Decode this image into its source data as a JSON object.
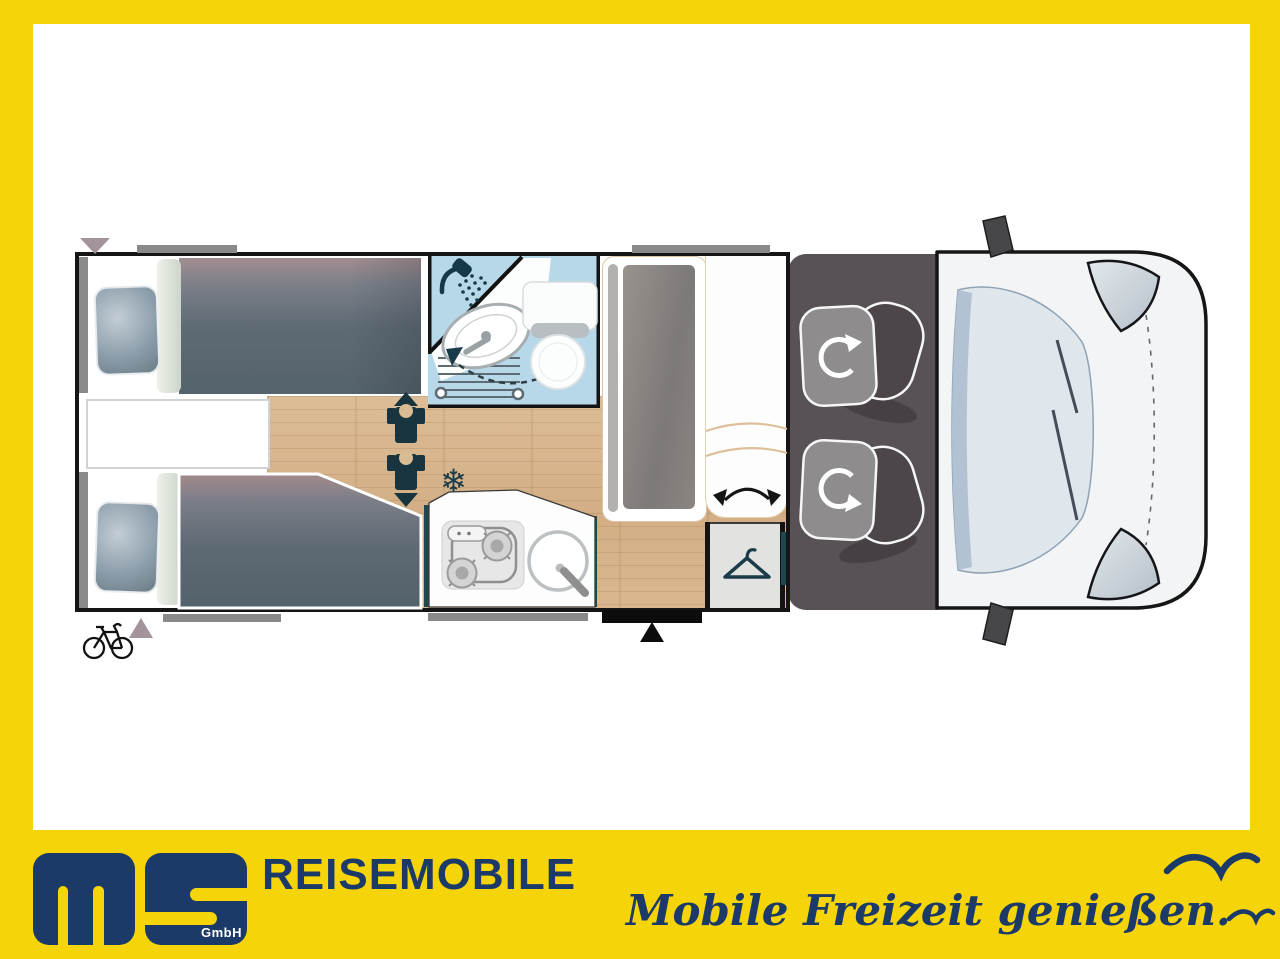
{
  "branding": {
    "logo_letters": "ms",
    "logo_suffix": "GmbH",
    "company_name": "REISEMOBILE",
    "slogan": "Mobile Freizeit genießen."
  },
  "colors": {
    "frame_yellow": "#f5d409",
    "brand_navy": "#1b3a68",
    "plan_icon_navy": "#1a3b49",
    "bathroom_blue": "#b7d8e8",
    "wood_floor": "#d7b48d",
    "cab_floor_gray": "#585155",
    "window_gray": "#8a8a8a",
    "marker_mauve": "#a2939c"
  },
  "floorplan": {
    "glyphs": {
      "snowflake": "❄"
    },
    "icons": {
      "shower-head-icon": "navy shower head with spray droplets",
      "swivel-sink-arrow-icon": "dashed arc with navy arrowheads between sink and toilet",
      "snowflake-icon": "❄",
      "travel-seat-icon": "navy seat/torso symbol with direction triangle (x2)",
      "coat-hanger-icon": "navy clothes hanger in wardrobe",
      "seat-swivel-arrow-icon": "curved double-headed arrow under side bench",
      "cab-seat-rotate-icon": "white circular arrow on each cab seat (x2)",
      "entry-door-marker": "black triangle at entry step",
      "rear-direction-marker": "mauve triangles at rear wall",
      "bicycle-icon": "black outline bicycle at rear",
      "seagull-icon": "navy gull silhouettes (x2)"
    }
  }
}
